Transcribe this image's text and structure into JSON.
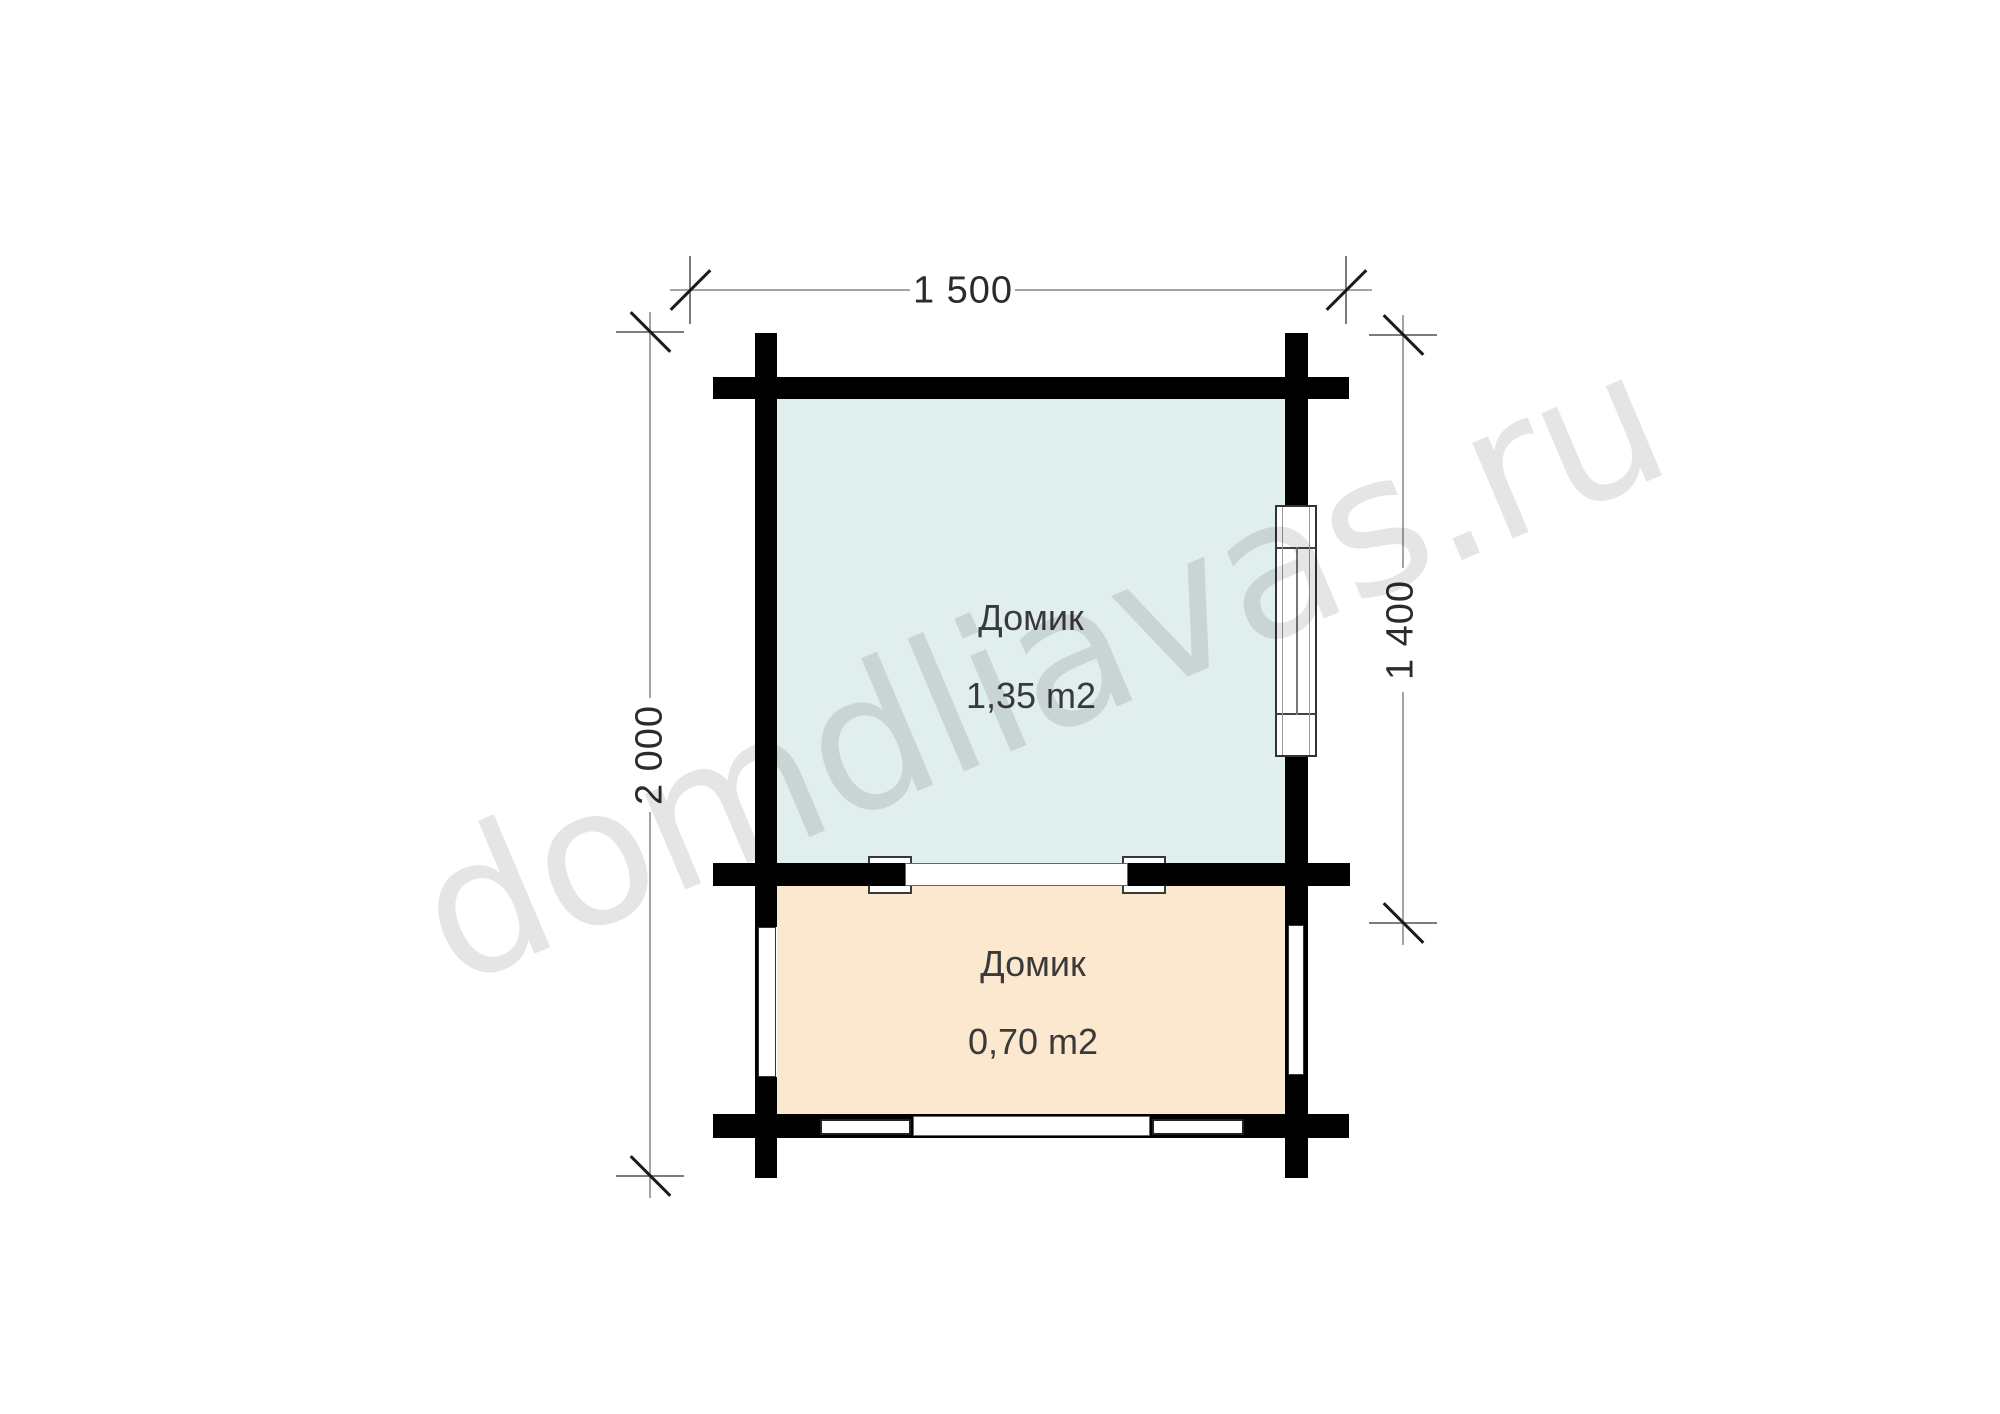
{
  "plan": {
    "rooms": [
      {
        "name": "Домик",
        "area": "1,35 m2"
      },
      {
        "name": "Домик",
        "area": "0,70 m2"
      }
    ],
    "dimensions": {
      "top": "1 500",
      "left": "2 000",
      "right": "1 400"
    }
  },
  "watermark": {
    "text": "domdliavas.ru"
  },
  "colors": {
    "room_upper": "#e0eeee",
    "room_lower": "#fce8cf",
    "wall": "#000000",
    "dim_line": "#a3a3a3",
    "dim_text": "#2b2b2b",
    "label_text": "#3a3a3a"
  }
}
